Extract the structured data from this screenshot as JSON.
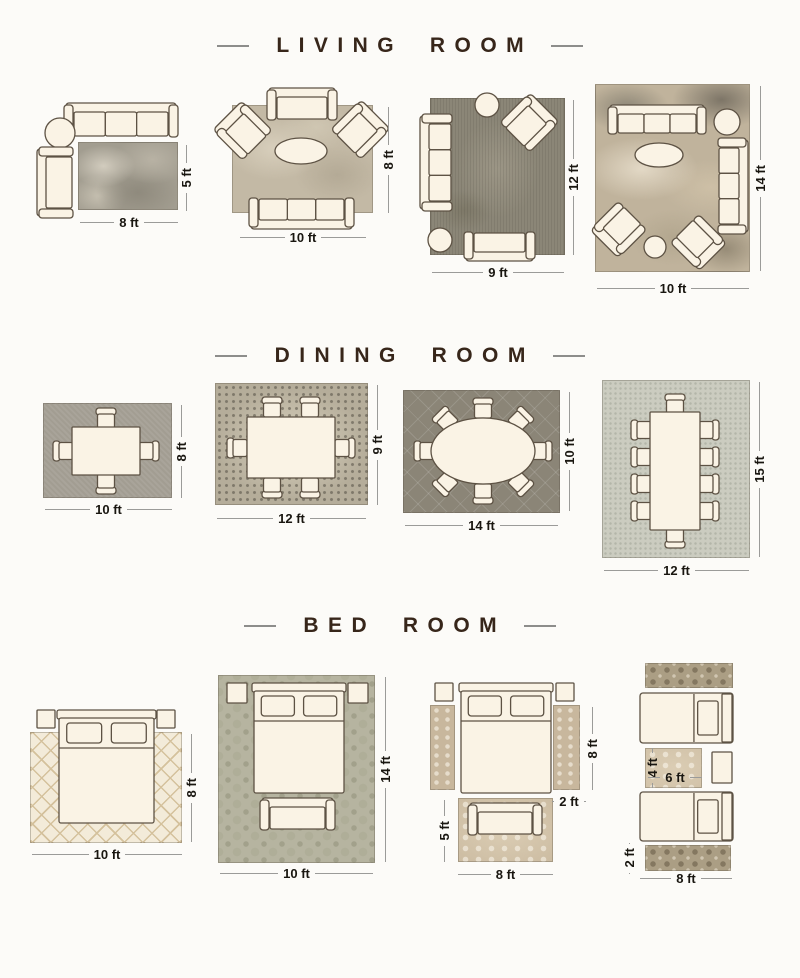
{
  "palette": {
    "page_bg": "#fcfbf8",
    "furniture_fill": "#faf3e5",
    "furniture_stroke": "#5d5244",
    "dim_text": "#191610",
    "dim_line": "#9b9b99",
    "title_color": "#37261a",
    "title_dash": "#8d8d8b"
  },
  "sections": [
    {
      "title": "LIVING ROOM"
    },
    {
      "title": "DINING ROOM"
    },
    {
      "title": "BED ROOM"
    }
  ],
  "rugs": [
    {
      "name": "living-rug-8x5",
      "x": 78,
      "y": 142,
      "w": 100,
      "h": 68,
      "pattern": "grayAbstract"
    },
    {
      "name": "living-rug-10x8",
      "x": 232,
      "y": 105,
      "w": 141,
      "h": 108,
      "pattern": "beigeMarble"
    },
    {
      "name": "living-rug-9x12",
      "x": 430,
      "y": 98,
      "w": 135,
      "h": 157,
      "pattern": "darkDistressed"
    },
    {
      "name": "living-rug-10x14",
      "x": 595,
      "y": 84,
      "w": 155,
      "h": 188,
      "pattern": "warmAbstract"
    },
    {
      "name": "dining-rug-10x8",
      "x": 43,
      "y": 403,
      "w": 129,
      "h": 95,
      "pattern": "grayTexture"
    },
    {
      "name": "dining-rug-12x9",
      "x": 215,
      "y": 383,
      "w": 153,
      "h": 122,
      "pattern": "mosaic"
    },
    {
      "name": "dining-rug-14x10",
      "x": 403,
      "y": 390,
      "w": 157,
      "h": 123,
      "pattern": "trellisDark"
    },
    {
      "name": "dining-rug-12x15",
      "x": 602,
      "y": 380,
      "w": 148,
      "h": 178,
      "pattern": "celadon"
    },
    {
      "name": "bed-rug-10x8",
      "x": 30,
      "y": 732,
      "w": 152,
      "h": 111,
      "pattern": "creamDiamond"
    },
    {
      "name": "bed-rug-10x14",
      "x": 218,
      "y": 675,
      "w": 157,
      "h": 188,
      "pattern": "sageDamask"
    },
    {
      "name": "bed-runner-left-8x2",
      "x": 430,
      "y": 705,
      "w": 25,
      "h": 85,
      "pattern": "fadedVintage"
    },
    {
      "name": "bed-runner-right-8x2",
      "x": 553,
      "y": 705,
      "w": 27,
      "h": 85,
      "pattern": "fadedVintage"
    },
    {
      "name": "bed-foot-rug-8x5",
      "x": 458,
      "y": 798,
      "w": 95,
      "h": 64,
      "pattern": "fadedVintage2"
    },
    {
      "name": "twin-runner-top-8x2",
      "x": 645,
      "y": 663,
      "w": 88,
      "h": 25,
      "pattern": "ornateRunner"
    },
    {
      "name": "twin-between-rug-6x4",
      "x": 645,
      "y": 748,
      "w": 57,
      "h": 40,
      "pattern": "fadedVintage2"
    },
    {
      "name": "twin-runner-bottom-8x2",
      "x": 645,
      "y": 845,
      "w": 86,
      "h": 26,
      "pattern": "ornateRunner"
    }
  ],
  "furniture": [
    {
      "kind": "sofa",
      "name": "sofa-3seat",
      "x": 64,
      "y": 103,
      "w": 114,
      "h": 36,
      "seats": 3,
      "facing": "down"
    },
    {
      "kind": "circle",
      "name": "round-side-table",
      "cx": 60,
      "cy": 133,
      "r": 15
    },
    {
      "kind": "sofa",
      "name": "armchair-chaise",
      "x": 37,
      "y": 147,
      "w": 38,
      "h": 71,
      "seats": 1,
      "facing": "right"
    },
    {
      "kind": "sofa",
      "name": "loveseat",
      "x": 267,
      "y": 88,
      "w": 70,
      "h": 34,
      "seats": 1,
      "facing": "down"
    },
    {
      "kind": "armchair",
      "name": "armchair",
      "cx": 243,
      "cy": 131,
      "w": 42,
      "h": 44,
      "rot": -45
    },
    {
      "kind": "armchair",
      "name": "armchair",
      "cx": 360,
      "cy": 130,
      "w": 42,
      "h": 44,
      "rot": 45
    },
    {
      "kind": "oval",
      "name": "oval-coffee-table",
      "cx": 301,
      "cy": 151,
      "rx": 26,
      "ry": 13
    },
    {
      "kind": "sofa",
      "name": "sofa-3seat",
      "x": 249,
      "y": 196,
      "w": 105,
      "h": 33,
      "seats": 3,
      "facing": "up"
    },
    {
      "kind": "circle",
      "name": "round-side-table",
      "cx": 487,
      "cy": 105,
      "r": 12
    },
    {
      "kind": "armchair",
      "name": "armchair",
      "cx": 529,
      "cy": 123,
      "w": 42,
      "h": 44,
      "rot": 45
    },
    {
      "kind": "sofa",
      "name": "sofa-3seat",
      "x": 420,
      "y": 114,
      "w": 34,
      "h": 97,
      "seats": 3,
      "facing": "right"
    },
    {
      "kind": "circle",
      "name": "round-ottoman",
      "cx": 440,
      "cy": 240,
      "r": 12
    },
    {
      "kind": "sofa",
      "name": "loveseat",
      "x": 464,
      "y": 230,
      "w": 71,
      "h": 31,
      "seats": 1,
      "facing": "up"
    },
    {
      "kind": "sofa",
      "name": "sofa-3seat",
      "x": 608,
      "y": 105,
      "w": 98,
      "h": 31,
      "seats": 3,
      "facing": "down"
    },
    {
      "kind": "circle",
      "name": "round-side-table",
      "cx": 727,
      "cy": 122,
      "r": 13
    },
    {
      "kind": "oval",
      "name": "oval-coffee-table",
      "cx": 659,
      "cy": 155,
      "rx": 24,
      "ry": 12
    },
    {
      "kind": "sofa",
      "name": "sofa-3seat",
      "x": 716,
      "y": 138,
      "w": 32,
      "h": 96,
      "seats": 3,
      "facing": "left"
    },
    {
      "kind": "armchair",
      "name": "armchair",
      "cx": 619,
      "cy": 229,
      "w": 40,
      "h": 42,
      "rot": -135
    },
    {
      "kind": "circle",
      "name": "round-ottoman",
      "cx": 655,
      "cy": 247,
      "r": 11
    },
    {
      "kind": "armchair",
      "name": "armchair",
      "cx": 698,
      "cy": 242,
      "w": 40,
      "h": 42,
      "rot": 135
    },
    {
      "kind": "chair",
      "name": "dining-chair",
      "cx": 106,
      "cy": 419,
      "rot": 0
    },
    {
      "kind": "chair",
      "name": "dining-chair",
      "cx": 106,
      "cy": 483,
      "rot": 180
    },
    {
      "kind": "chair",
      "name": "dining-chair",
      "cx": 64,
      "cy": 451,
      "rot": -90
    },
    {
      "kind": "chair",
      "name": "dining-chair",
      "cx": 148,
      "cy": 451,
      "rot": 90
    },
    {
      "kind": "table",
      "name": "dining-table",
      "x": 72,
      "y": 427,
      "w": 68,
      "h": 48
    },
    {
      "kind": "chair",
      "name": "dining-chair",
      "cx": 272,
      "cy": 408,
      "rot": 0
    },
    {
      "kind": "chair",
      "name": "dining-chair",
      "cx": 310,
      "cy": 408,
      "rot": 0
    },
    {
      "kind": "chair",
      "name": "dining-chair",
      "cx": 272,
      "cy": 487,
      "rot": 180
    },
    {
      "kind": "chair",
      "name": "dining-chair",
      "cx": 310,
      "cy": 487,
      "rot": 180
    },
    {
      "kind": "chair",
      "name": "dining-chair",
      "cx": 238,
      "cy": 448,
      "rot": -90
    },
    {
      "kind": "chair",
      "name": "dining-chair",
      "cx": 344,
      "cy": 448,
      "rot": 90
    },
    {
      "kind": "table",
      "name": "dining-table",
      "x": 247,
      "y": 417,
      "w": 88,
      "h": 61
    },
    {
      "kind": "chair",
      "name": "dining-chair",
      "cx": 483,
      "cy": 409,
      "rot": 0
    },
    {
      "kind": "chair",
      "name": "dining-chair",
      "cx": 520,
      "cy": 420,
      "rot": 45
    },
    {
      "kind": "chair",
      "name": "dining-chair",
      "cx": 541,
      "cy": 451,
      "rot": 90
    },
    {
      "kind": "chair",
      "name": "dining-chair",
      "cx": 520,
      "cy": 483,
      "rot": 135
    },
    {
      "kind": "chair",
      "name": "dining-chair",
      "cx": 483,
      "cy": 493,
      "rot": 180
    },
    {
      "kind": "chair",
      "name": "dining-chair",
      "cx": 446,
      "cy": 483,
      "rot": -135
    },
    {
      "kind": "chair",
      "name": "dining-chair",
      "cx": 425,
      "cy": 451,
      "rot": -90
    },
    {
      "kind": "chair",
      "name": "dining-chair",
      "cx": 446,
      "cy": 420,
      "rot": -45
    },
    {
      "kind": "ovaltable",
      "name": "oval-dining-table",
      "cx": 483,
      "cy": 451,
      "rx": 52,
      "ry": 33
    },
    {
      "kind": "chair",
      "name": "dining-chair",
      "cx": 675,
      "cy": 405,
      "rot": 0
    },
    {
      "kind": "chair",
      "name": "dining-chair",
      "cx": 675,
      "cy": 537,
      "rot": 180
    },
    {
      "kind": "chair",
      "name": "dining-chair",
      "cx": 642,
      "cy": 430,
      "rot": -90
    },
    {
      "kind": "chair",
      "name": "dining-chair",
      "cx": 642,
      "cy": 457,
      "rot": -90
    },
    {
      "kind": "chair",
      "name": "dining-chair",
      "cx": 642,
      "cy": 484,
      "rot": -90
    },
    {
      "kind": "chair",
      "name": "dining-chair",
      "cx": 642,
      "cy": 511,
      "rot": -90
    },
    {
      "kind": "chair",
      "name": "dining-chair",
      "cx": 708,
      "cy": 430,
      "rot": 90
    },
    {
      "kind": "chair",
      "name": "dining-chair",
      "cx": 708,
      "cy": 457,
      "rot": 90
    },
    {
      "kind": "chair",
      "name": "dining-chair",
      "cx": 708,
      "cy": 484,
      "rot": 90
    },
    {
      "kind": "chair",
      "name": "dining-chair",
      "cx": 708,
      "cy": 511,
      "rot": 90
    },
    {
      "kind": "table",
      "name": "dining-table",
      "x": 650,
      "y": 412,
      "w": 50,
      "h": 118
    },
    {
      "kind": "nightstand",
      "name": "nightstand",
      "x": 37,
      "y": 710,
      "w": 18,
      "h": 18
    },
    {
      "kind": "nightstand",
      "name": "nightstand",
      "x": 157,
      "y": 710,
      "w": 18,
      "h": 18
    },
    {
      "kind": "bed",
      "name": "queen-bed",
      "x": 58,
      "y": 710,
      "w": 97,
      "h": 113
    },
    {
      "kind": "nightstand",
      "name": "nightstand",
      "x": 227,
      "y": 683,
      "w": 20,
      "h": 20
    },
    {
      "kind": "nightstand",
      "name": "nightstand",
      "x": 348,
      "y": 683,
      "w": 20,
      "h": 20
    },
    {
      "kind": "bed",
      "name": "queen-bed",
      "x": 253,
      "y": 683,
      "w": 92,
      "h": 110
    },
    {
      "kind": "sofa",
      "name": "foot-bench",
      "x": 260,
      "y": 798,
      "w": 75,
      "h": 34,
      "seats": 1,
      "facing": "down"
    },
    {
      "kind": "nightstand",
      "name": "nightstand",
      "x": 435,
      "y": 683,
      "w": 18,
      "h": 18
    },
    {
      "kind": "nightstand",
      "name": "nightstand",
      "x": 556,
      "y": 683,
      "w": 18,
      "h": 18
    },
    {
      "kind": "bed",
      "name": "queen-bed",
      "x": 460,
      "y": 683,
      "w": 92,
      "h": 110
    },
    {
      "kind": "sofa",
      "name": "foot-bench",
      "x": 468,
      "y": 803,
      "w": 74,
      "h": 34,
      "seats": 1,
      "facing": "down"
    },
    {
      "kind": "twinbed",
      "name": "twin-bed",
      "x": 640,
      "y": 693,
      "w": 93,
      "h": 50
    },
    {
      "kind": "nightstand",
      "name": "nightstand",
      "x": 712,
      "y": 752,
      "w": 20,
      "h": 31
    },
    {
      "kind": "twinbed",
      "name": "twin-bed",
      "x": 640,
      "y": 792,
      "w": 93,
      "h": 49
    }
  ],
  "dimensions": [
    {
      "label": "8 ft",
      "orient": "h",
      "x": 80,
      "y": 222,
      "len": 98
    },
    {
      "label": "5 ft",
      "orient": "v",
      "x": 186,
      "y": 145,
      "len": 66
    },
    {
      "label": "10 ft",
      "orient": "h",
      "x": 240,
      "y": 237,
      "len": 126
    },
    {
      "label": "8 ft",
      "orient": "v",
      "x": 388,
      "y": 107,
      "len": 106
    },
    {
      "label": "9 ft",
      "orient": "h",
      "x": 432,
      "y": 272,
      "len": 132
    },
    {
      "label": "12 ft",
      "orient": "v",
      "x": 573,
      "y": 100,
      "len": 155
    },
    {
      "label": "10 ft",
      "orient": "h",
      "x": 597,
      "y": 288,
      "len": 152
    },
    {
      "label": "14 ft",
      "orient": "v",
      "x": 760,
      "y": 86,
      "len": 185
    },
    {
      "label": "10 ft",
      "orient": "h",
      "x": 45,
      "y": 509,
      "len": 127
    },
    {
      "label": "8 ft",
      "orient": "v",
      "x": 181,
      "y": 405,
      "len": 93
    },
    {
      "label": "12 ft",
      "orient": "h",
      "x": 217,
      "y": 518,
      "len": 149
    },
    {
      "label": "9 ft",
      "orient": "v",
      "x": 377,
      "y": 385,
      "len": 120
    },
    {
      "label": "14 ft",
      "orient": "h",
      "x": 405,
      "y": 525,
      "len": 153
    },
    {
      "label": "10 ft",
      "orient": "v",
      "x": 569,
      "y": 392,
      "len": 119
    },
    {
      "label": "12 ft",
      "orient": "h",
      "x": 604,
      "y": 570,
      "len": 145
    },
    {
      "label": "15 ft",
      "orient": "v",
      "x": 759,
      "y": 382,
      "len": 175
    },
    {
      "label": "10 ft",
      "orient": "h",
      "x": 32,
      "y": 854,
      "len": 150
    },
    {
      "label": "8 ft",
      "orient": "v",
      "x": 191,
      "y": 734,
      "len": 108
    },
    {
      "label": "10 ft",
      "orient": "h",
      "x": 220,
      "y": 873,
      "len": 153
    },
    {
      "label": "14 ft",
      "orient": "v",
      "x": 385,
      "y": 677,
      "len": 185
    },
    {
      "label": "8 ft",
      "orient": "v",
      "x": 592,
      "y": 707,
      "len": 83
    },
    {
      "label": "2 ft",
      "orient": "h",
      "x": 552,
      "y": 801,
      "len": 34
    },
    {
      "label": "5 ft",
      "orient": "v",
      "x": 444,
      "y": 800,
      "len": 62
    },
    {
      "label": "8 ft",
      "orient": "h",
      "x": 458,
      "y": 874,
      "len": 95
    },
    {
      "label": "4 ft",
      "orient": "v",
      "x": 652,
      "y": 748,
      "len": 40
    },
    {
      "label": "6 ft",
      "orient": "h",
      "x": 648,
      "y": 777,
      "len": 54
    },
    {
      "label": "2 ft",
      "orient": "v",
      "x": 629,
      "y": 843,
      "len": 30
    },
    {
      "label": "8 ft",
      "orient": "h",
      "x": 640,
      "y": 878,
      "len": 92
    }
  ]
}
